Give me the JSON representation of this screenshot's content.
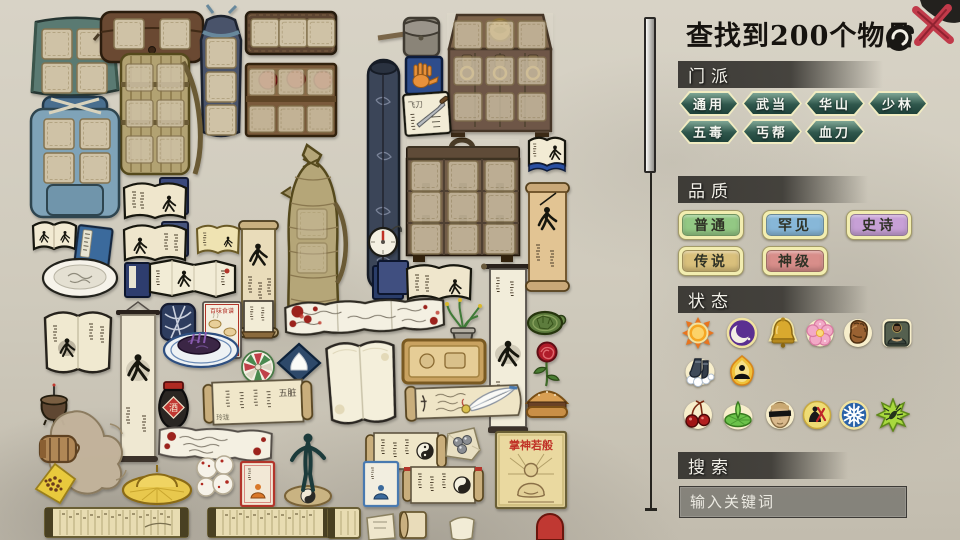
{
  "header": {
    "title": "查找到200个物品"
  },
  "sections": {
    "sect": {
      "title": "门派",
      "options": [
        "通用",
        "武当",
        "华山",
        "少林",
        "五毒",
        "丐帮",
        "血刀"
      ],
      "button_color": "#2f574c",
      "border_color": "#f1ecc2"
    },
    "quality": {
      "title": "品质",
      "options": [
        {
          "label": "普通",
          "color": "#93c884"
        },
        {
          "label": "罕见",
          "color": "#87b7d8"
        },
        {
          "label": "史诗",
          "color": "#c7a0d6"
        },
        {
          "label": "传说",
          "color": "#d9c07c"
        },
        {
          "label": "神级",
          "color": "#d88e8a"
        }
      ],
      "border_color": "#f2edb0"
    },
    "status": {
      "title": "状态",
      "icons": [
        {
          "name": "sun-icon"
        },
        {
          "name": "moon-icon"
        },
        {
          "name": "bell-icon"
        },
        {
          "name": "blossom-icon"
        },
        {
          "name": "fist-icon"
        },
        {
          "name": "monk-icon"
        },
        {
          "name": "cloud-boots-icon"
        },
        {
          "name": "flame-meditation-icon"
        },
        {
          "name": "cherries-icon"
        },
        {
          "name": "lotus-icon"
        },
        {
          "name": "blindfold-icon"
        },
        {
          "name": "assassin-icon"
        },
        {
          "name": "snowflake-icon"
        },
        {
          "name": "poison-insect-icon"
        }
      ]
    },
    "search": {
      "title": "搜索",
      "placeholder": "输入关键词"
    }
  },
  "inventory": {
    "item_labels": {
      "wine_jar": "酒",
      "palm_poster": "掌神若般",
      "menu_card": "百味食谱",
      "organs_scroll": "五脏",
      "organs_scroll_end": "玲珑",
      "knife_note": "飞刀"
    },
    "items": [
      "teal-bag",
      "waist-satchel",
      "floral-pouch",
      "bandolier",
      "gray-pouch",
      "wooden-chest",
      "palm-manual-icon",
      "fruit-crate",
      "knife-note",
      "blue-manual-icon",
      "bamboo-backpack",
      "blue-backpack",
      "scroll-case",
      "wooden-cabinet",
      "compass-mirror",
      "wicker-flask",
      "small-manual",
      "blue-tome",
      "manual-open-a",
      "manual-open-b",
      "yellow-booklet",
      "white-plate",
      "accordion-manual",
      "tall-scroll",
      "book-stack-open",
      "bloodstained-scroll",
      "orchid-pot",
      "swordsman-banner",
      "parchment-scroll",
      "turtle",
      "rose",
      "blank-book",
      "wooden-tray",
      "quill-scroll",
      "meat-bun",
      "wine-jar",
      "hanging-scroll",
      "recipe-menu",
      "purple-dish",
      "tablet-card",
      "pinwheel-plate",
      "salt-pack",
      "organs-scroll",
      "incense-burner",
      "fist-strike",
      "bean-pouch",
      "straw-hat",
      "blood-buns",
      "bloody-letter",
      "meditation-card",
      "taichi-statue",
      "bamboo-slip-scroll",
      "bamboo-slip-scroll-2",
      "open-tome",
      "palm-poster",
      "yinyang-scroll",
      "metal-balls-paper",
      "blue-meditation-card",
      "yinyang-scroll-2",
      "scroll-fragment",
      "paper-fragment",
      "red-fragment"
    ]
  },
  "colors": {
    "paper": "#cfcabc",
    "header_bar": "#32302c",
    "close_x": "#c13a4a",
    "glow_border": "#f0e2a0"
  }
}
